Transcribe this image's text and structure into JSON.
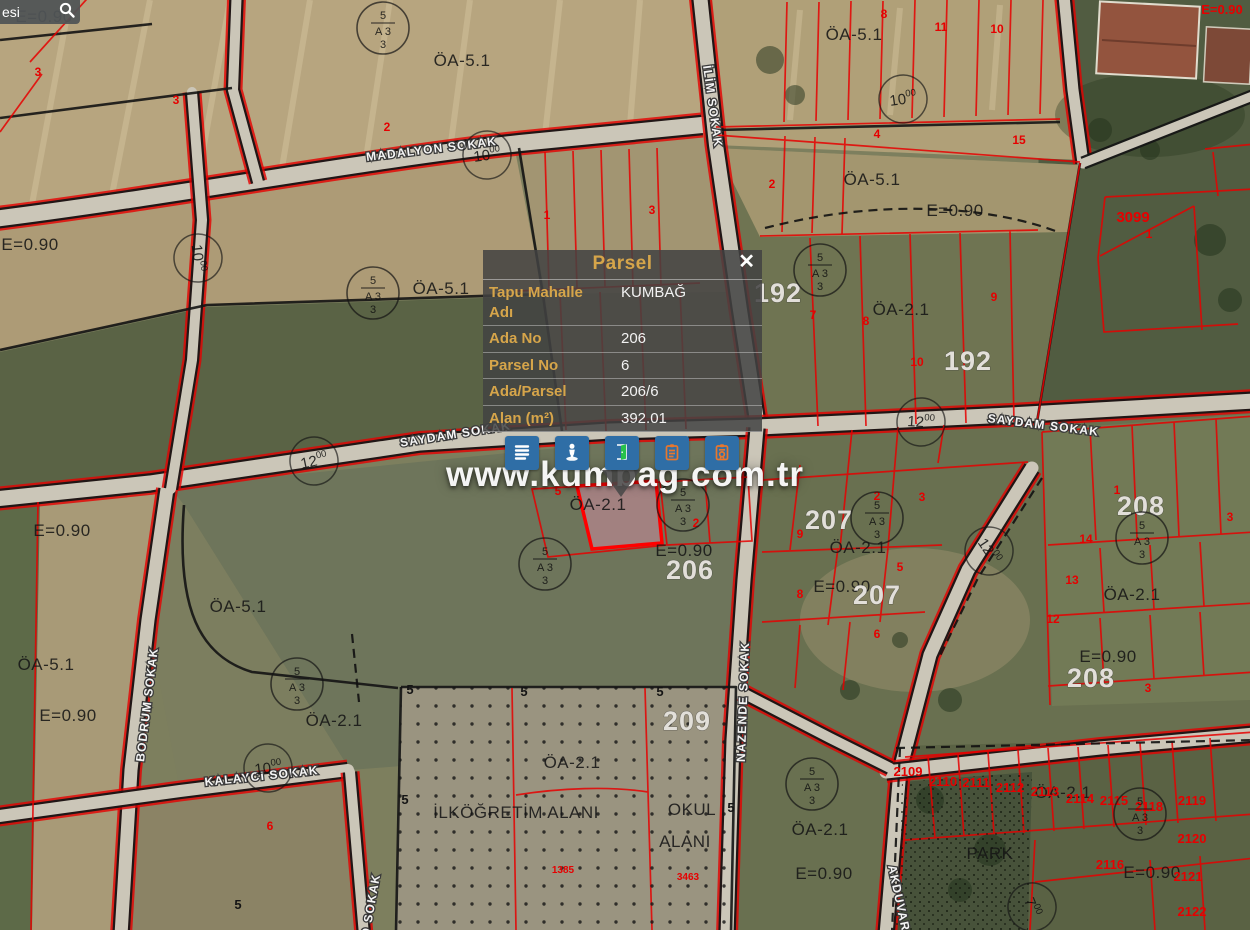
{
  "search": {
    "value": "esi"
  },
  "watermark": "www.kumbag.com.tr",
  "popup": {
    "title": "Parsel",
    "close_label": "✕",
    "rows": [
      {
        "label": "Tapu Mahalle Adı",
        "value": "KUMBAĞ"
      },
      {
        "label": "Ada No",
        "value": "206"
      },
      {
        "label": "Parsel No",
        "value": "6"
      },
      {
        "label": "Ada/Parsel",
        "value": "206/6"
      },
      {
        "label": "Alan (m²)",
        "value": "392.01"
      }
    ],
    "toolbar_icons": [
      {
        "name": "menu-list-icon"
      },
      {
        "name": "street-view-icon"
      },
      {
        "name": "door-icon"
      },
      {
        "name": "clipboard-icon"
      },
      {
        "name": "report-icon"
      }
    ]
  },
  "colors": {
    "accent_gold": "#d6a54a",
    "button_blue": "#2f6ea6",
    "parcel_red": "#e60000",
    "selected_parcel_pink": "#d08fa3"
  },
  "map": {
    "street_labels": [
      {
        "text": "MADALYON SOKAK",
        "x": 432,
        "y": 153,
        "rot": -7
      },
      {
        "text": "İLİM SOKAK",
        "x": 703,
        "y": 66,
        "rot": 82,
        "anchor": "start"
      },
      {
        "text": "SAYDAM SOKAK",
        "x": 456,
        "y": 438,
        "rot": -9
      },
      {
        "text": "SAYDAM SOKAK",
        "x": 1043,
        "y": 429,
        "rot": 7
      },
      {
        "text": "BODRUM SOKAK",
        "x": 151,
        "y": 705,
        "rot": -83
      },
      {
        "text": "KALAYCI SOKAK",
        "x": 262,
        "y": 780,
        "rot": -6
      },
      {
        "text": "NAZENDE SOKAK",
        "x": 747,
        "y": 702,
        "rot": -88
      },
      {
        "text": "AKDUVAR",
        "x": 888,
        "y": 866,
        "rot": 78,
        "anchor": "start"
      },
      {
        "text": "O SOKAK",
        "x": 369,
        "y": 938,
        "rot": -80,
        "anchor": "start"
      }
    ],
    "zone_labels": [
      {
        "text": "E=0.90",
        "x": 44,
        "y": 22
      },
      {
        "text": "ÖA-5.1",
        "x": 462,
        "y": 66
      },
      {
        "text": "ÖA-5.1",
        "x": 854,
        "y": 40
      },
      {
        "text": "E=0.90",
        "x": 30,
        "y": 250
      },
      {
        "text": "ÖA-5.1",
        "x": 872,
        "y": 185
      },
      {
        "text": "E=0.90",
        "x": 955,
        "y": 216
      },
      {
        "text": "ÖA-5.1",
        "x": 441,
        "y": 294
      },
      {
        "text": "ÖA-2.1",
        "x": 901,
        "y": 315
      },
      {
        "text": "ÖA-2.1",
        "x": 598,
        "y": 510
      },
      {
        "text": "E=0.90",
        "x": 684,
        "y": 556
      },
      {
        "text": "ÖA-2.1",
        "x": 858,
        "y": 553
      },
      {
        "text": "E=0.90",
        "x": 842,
        "y": 592
      },
      {
        "text": "E=0.90",
        "x": 62,
        "y": 536
      },
      {
        "text": "ÖA-5.1",
        "x": 238,
        "y": 612
      },
      {
        "text": "ÖA-5.1",
        "x": 46,
        "y": 670
      },
      {
        "text": "E=0.90",
        "x": 68,
        "y": 721
      },
      {
        "text": "ÖA-2.1",
        "x": 334,
        "y": 726
      },
      {
        "text": "ÖA-2.1",
        "x": 1132,
        "y": 600
      },
      {
        "text": "E=0.90",
        "x": 1108,
        "y": 662
      },
      {
        "text": "ÖA-2.1",
        "x": 572,
        "y": 768
      },
      {
        "text": "İLKÖĞRETİM ALANI",
        "x": 516,
        "y": 818
      },
      {
        "text": "OKUL",
        "x": 692,
        "y": 815
      },
      {
        "text": "ALANI",
        "x": 685,
        "y": 847
      },
      {
        "text": "ÖA-2.1",
        "x": 820,
        "y": 835
      },
      {
        "text": "E=0.90",
        "x": 824,
        "y": 879
      },
      {
        "text": "ÖA-2.1",
        "x": 1063,
        "y": 798
      },
      {
        "text": "PARK",
        "x": 990,
        "y": 859
      },
      {
        "text": "E=0.90",
        "x": 1152,
        "y": 878
      }
    ],
    "block_numbers": [
      {
        "text": "192",
        "x": 778,
        "y": 302
      },
      {
        "text": "192",
        "x": 968,
        "y": 370
      },
      {
        "text": "206",
        "x": 690,
        "y": 579
      },
      {
        "text": "207",
        "x": 829,
        "y": 529
      },
      {
        "text": "207",
        "x": 877,
        "y": 604
      },
      {
        "text": "208",
        "x": 1141,
        "y": 515
      },
      {
        "text": "208",
        "x": 1091,
        "y": 687
      },
      {
        "text": "209",
        "x": 687,
        "y": 730
      }
    ],
    "road_widths": [
      {
        "text": "10.00",
        "x": 487,
        "y": 155,
        "rot": -8
      },
      {
        "text": "10.00",
        "x": 198,
        "y": 258,
        "rot": 84
      },
      {
        "text": "12.00",
        "x": 314,
        "y": 461,
        "rot": -12
      },
      {
        "text": "12.00",
        "x": 921,
        "y": 422,
        "rot": 4
      },
      {
        "text": "12.00",
        "x": 989,
        "y": 551,
        "rot": 56
      },
      {
        "text": "10.00",
        "x": 268,
        "y": 768,
        "rot": -6
      },
      {
        "text": "7.00",
        "x": 1032,
        "y": 907,
        "rot": 68
      },
      {
        "text": "10.00",
        "x": 903,
        "y": 99,
        "rot": -8
      }
    ],
    "red_numbers": [
      {
        "text": "3",
        "x": 38,
        "y": 76
      },
      {
        "text": "3",
        "x": 176,
        "y": 104
      },
      {
        "text": "2",
        "x": 387,
        "y": 131
      },
      {
        "text": "1",
        "x": 547,
        "y": 219
      },
      {
        "text": "3",
        "x": 652,
        "y": 214
      },
      {
        "text": "2",
        "x": 772,
        "y": 188
      },
      {
        "text": "8",
        "x": 884,
        "y": 18
      },
      {
        "text": "11",
        "x": 941,
        "y": 31
      },
      {
        "text": "10",
        "x": 997,
        "y": 33
      },
      {
        "text": "4",
        "x": 877,
        "y": 138
      },
      {
        "text": "15",
        "x": 1019,
        "y": 144
      },
      {
        "text": "3099",
        "x": 1133,
        "y": 222,
        "s": 15
      },
      {
        "text": "1",
        "x": 1149,
        "y": 238
      },
      {
        "text": "7",
        "x": 813,
        "y": 319
      },
      {
        "text": "8",
        "x": 866,
        "y": 325
      },
      {
        "text": "9",
        "x": 994,
        "y": 301
      },
      {
        "text": "10",
        "x": 917,
        "y": 366
      },
      {
        "text": "9",
        "x": 800,
        "y": 538
      },
      {
        "text": "2",
        "x": 877,
        "y": 500
      },
      {
        "text": "3",
        "x": 922,
        "y": 501
      },
      {
        "text": "5",
        "x": 900,
        "y": 571
      },
      {
        "text": "8",
        "x": 800,
        "y": 598
      },
      {
        "text": "6",
        "x": 877,
        "y": 638
      },
      {
        "text": "5",
        "x": 558,
        "y": 495
      },
      {
        "text": "2",
        "x": 696,
        "y": 527
      },
      {
        "text": "1",
        "x": 1117,
        "y": 494
      },
      {
        "text": "3",
        "x": 1230,
        "y": 521
      },
      {
        "text": "13",
        "x": 1072,
        "y": 584
      },
      {
        "text": "12",
        "x": 1053,
        "y": 623
      },
      {
        "text": "14",
        "x": 1086,
        "y": 543
      },
      {
        "text": "3",
        "x": 1148,
        "y": 692
      },
      {
        "text": "2109",
        "x": 908,
        "y": 776,
        "s": 13
      },
      {
        "text": "2110",
        "x": 943,
        "y": 786,
        "s": 13
      },
      {
        "text": "2111",
        "x": 976,
        "y": 787,
        "s": 13
      },
      {
        "text": "2112",
        "x": 1010,
        "y": 792,
        "s": 13
      },
      {
        "text": "2113",
        "x": 1045,
        "y": 796,
        "s": 13
      },
      {
        "text": "2114",
        "x": 1080,
        "y": 803,
        "s": 13
      },
      {
        "text": "2115",
        "x": 1114,
        "y": 805,
        "s": 13
      },
      {
        "text": "2118",
        "x": 1149,
        "y": 811,
        "s": 13
      },
      {
        "text": "2119",
        "x": 1192,
        "y": 805,
        "s": 13
      },
      {
        "text": "2120",
        "x": 1192,
        "y": 843,
        "s": 13
      },
      {
        "text": "2116",
        "x": 1110,
        "y": 869,
        "s": 13
      },
      {
        "text": "2121",
        "x": 1188,
        "y": 881,
        "s": 13
      },
      {
        "text": "2122",
        "x": 1192,
        "y": 916,
        "s": 13
      },
      {
        "text": "1385",
        "x": 563,
        "y": 873,
        "s": 10
      },
      {
        "text": "3463",
        "x": 688,
        "y": 880,
        "s": 10
      },
      {
        "text": "6",
        "x": 270,
        "y": 830
      },
      {
        "text": "E=0.90",
        "x": 1222,
        "y": 14,
        "s": 13
      }
    ],
    "black_numbers": [
      {
        "text": "5",
        "x": 410,
        "y": 694
      },
      {
        "text": "5",
        "x": 524,
        "y": 696
      },
      {
        "text": "5",
        "x": 660,
        "y": 696
      },
      {
        "text": "5",
        "x": 405,
        "y": 804
      },
      {
        "text": "5",
        "x": 731,
        "y": 812
      },
      {
        "text": "5",
        "x": 238,
        "y": 909
      }
    ],
    "legend_symbol": {
      "top": "5",
      "mid": "A  3",
      "bot": "3"
    },
    "legend_positions": [
      {
        "x": 383,
        "y": 28
      },
      {
        "x": 373,
        "y": 293
      },
      {
        "x": 820,
        "y": 270
      },
      {
        "x": 545,
        "y": 564
      },
      {
        "x": 683,
        "y": 505
      },
      {
        "x": 877,
        "y": 518
      },
      {
        "x": 1142,
        "y": 538
      },
      {
        "x": 297,
        "y": 684
      },
      {
        "x": 812,
        "y": 784
      },
      {
        "x": 1140,
        "y": 814
      }
    ]
  }
}
